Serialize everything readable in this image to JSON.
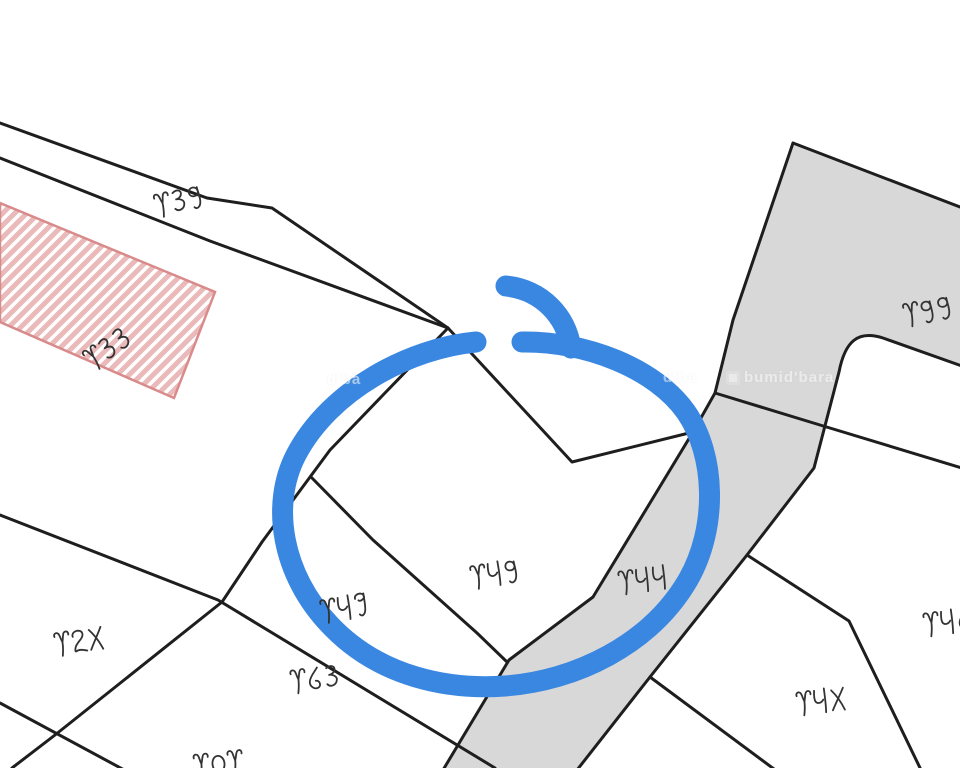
{
  "map": {
    "type": "cadastral-plot-map",
    "colors": {
      "bg": "#ffffff",
      "line": "#1e1e1e",
      "gray_fill": "#d8d8d8",
      "hatch_border": "#d98a8a",
      "hatch_stripe": "#eab9b9",
      "annotation_blue": "#3a87e2",
      "label_ink": "#333333"
    },
    "parcel_labels": [
      {
        "number": "৪৩৯",
        "x": 178,
        "y": 201,
        "rotation": -14
      },
      {
        "number": "৪৩৩",
        "x": 107,
        "y": 349,
        "rotation": -35
      },
      {
        "number": "৪২৫",
        "x": 78,
        "y": 641,
        "rotation": -10
      },
      {
        "number": "৪৮৭",
        "x": 344,
        "y": 608,
        "rotation": -10
      },
      {
        "number": "৪৮৯",
        "x": 494,
        "y": 574,
        "rotation": -10
      },
      {
        "number": "৪৮৮",
        "x": 642,
        "y": 580,
        "rotation": -8
      },
      {
        "number": "৪৯৯",
        "x": 927,
        "y": 311,
        "rotation": -12
      },
      {
        "number": "৪৮৬",
        "x": 947,
        "y": 622,
        "rotation": -8
      },
      {
        "number": "৪৮৫",
        "x": 820,
        "y": 701,
        "rotation": -8
      },
      {
        "number": "৪৬৩",
        "x": 314,
        "y": 679,
        "rotation": -8
      },
      {
        "number": "৪০৪",
        "x": 217,
        "y": 764,
        "rotation": -6
      }
    ],
    "highlight_annotation": "hand-drawn blue circle around parcels ৪৮৯ / ৪৮৭ / ৪৮৮",
    "watermarks": [
      {
        "text": "d'ba",
        "x": 327,
        "y": 371,
        "size": 15,
        "opacity": 0.55,
        "logo": false
      },
      {
        "text": "d'ba",
        "x": 663,
        "y": 369,
        "size": 15,
        "opacity": 0.5,
        "logo": false
      },
      {
        "text": "bumid'bara",
        "x": 726,
        "y": 369,
        "size": 15,
        "opacity": 0.5,
        "logo": true
      }
    ]
  }
}
